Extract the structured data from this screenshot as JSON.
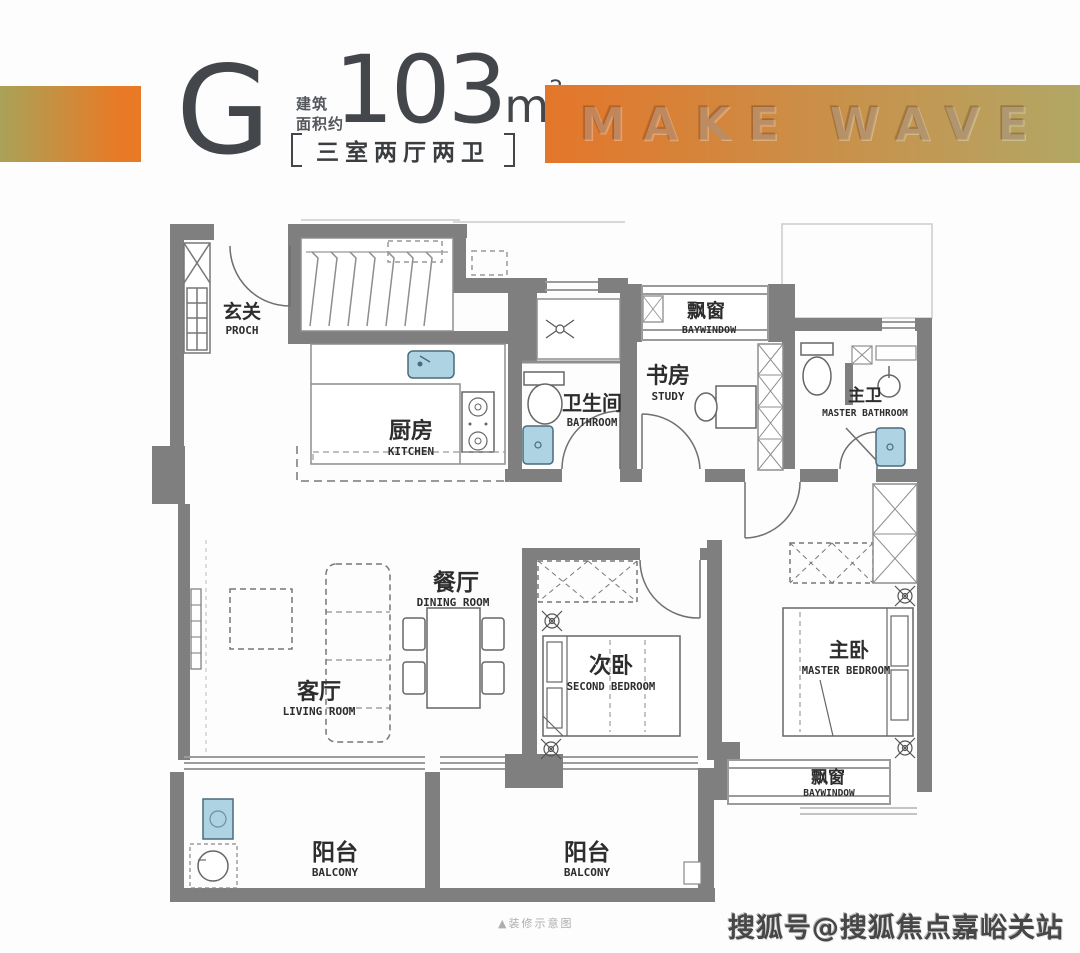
{
  "header": {
    "unit_letter": "G",
    "area_label_line1": "建筑",
    "area_label_line2": "面积约",
    "area_value": "103",
    "area_unit": "m",
    "area_exponent": "2",
    "layout_text": "三室两厅两卫",
    "banner_text": "MAKE WAVE"
  },
  "plan": {
    "rooms": [
      {
        "cn": "玄关",
        "en": "PROCH"
      },
      {
        "cn": "厨房",
        "en": "KITCHEN"
      },
      {
        "cn": "卫生间",
        "en": "BATHROOM"
      },
      {
        "cn": "书房",
        "en": "STUDY"
      },
      {
        "cn": "飘窗",
        "en": "BAYWINDOW"
      },
      {
        "cn": "主卫",
        "en": "MASTER BATHROOM"
      },
      {
        "cn": "餐厅",
        "en": "DINING ROOM"
      },
      {
        "cn": "客厅",
        "en": "LIVING ROOM"
      },
      {
        "cn": "次卧",
        "en": "SECOND BEDROOM"
      },
      {
        "cn": "主卧",
        "en": "MASTER BEDROOM"
      },
      {
        "cn": "飘窗",
        "en": "BAYWINDOW"
      },
      {
        "cn": "阳台",
        "en": "BALCONY"
      },
      {
        "cn": "阳台",
        "en": "BALCONY"
      }
    ]
  },
  "footer": {
    "note": "▲装修示意图",
    "watermark": "搜狐号@搜狐焦点嘉峪关站"
  },
  "colors": {
    "accent_orange": "#e97a25",
    "gradient_olive": "#a9a258",
    "wall_gray": "#7f7f7f",
    "fixture_blue": "#aed3e2",
    "text_dark": "#43464a"
  }
}
